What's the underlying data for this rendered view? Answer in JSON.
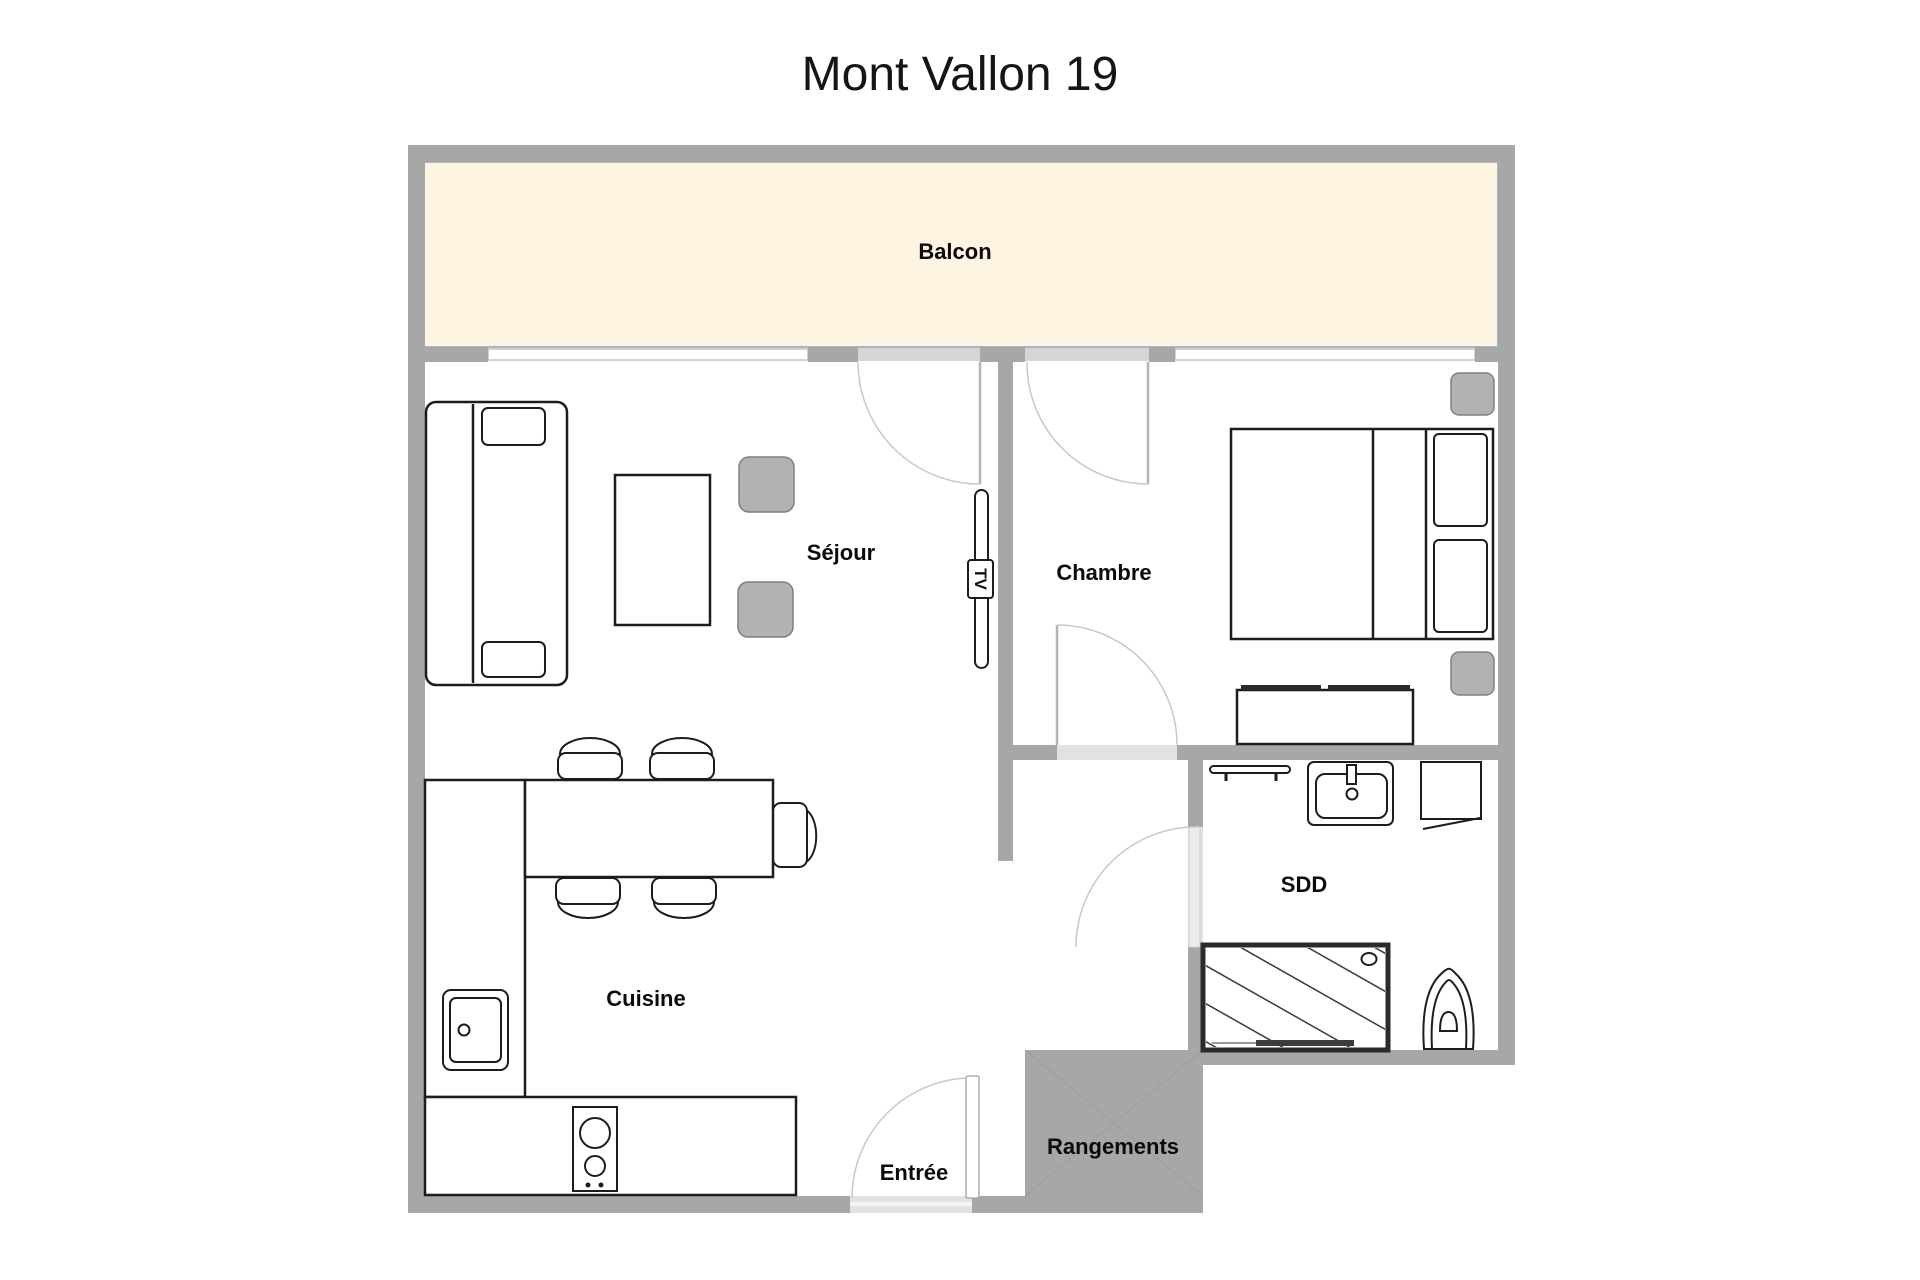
{
  "title": "Mont Vallon 19",
  "rooms": {
    "balcony": {
      "label": "Balcon"
    },
    "living": {
      "label": "Séjour"
    },
    "bedroom": {
      "label": "Chambre"
    },
    "kitchen": {
      "label": "Cuisine"
    },
    "shower_room": {
      "label": "SDD"
    },
    "entrance": {
      "label": "Entrée"
    },
    "storage": {
      "label": "Rangements"
    }
  },
  "furniture": {
    "tv_label": "TV"
  },
  "colors": {
    "wall": "#a7a7a7",
    "balcony_fill": "#fdf5e1",
    "balcony_border": "#a3bac6",
    "panel": "#d5d5d5",
    "furniture_gray": "#b2b2b2",
    "outline": "#1d1d1d"
  }
}
